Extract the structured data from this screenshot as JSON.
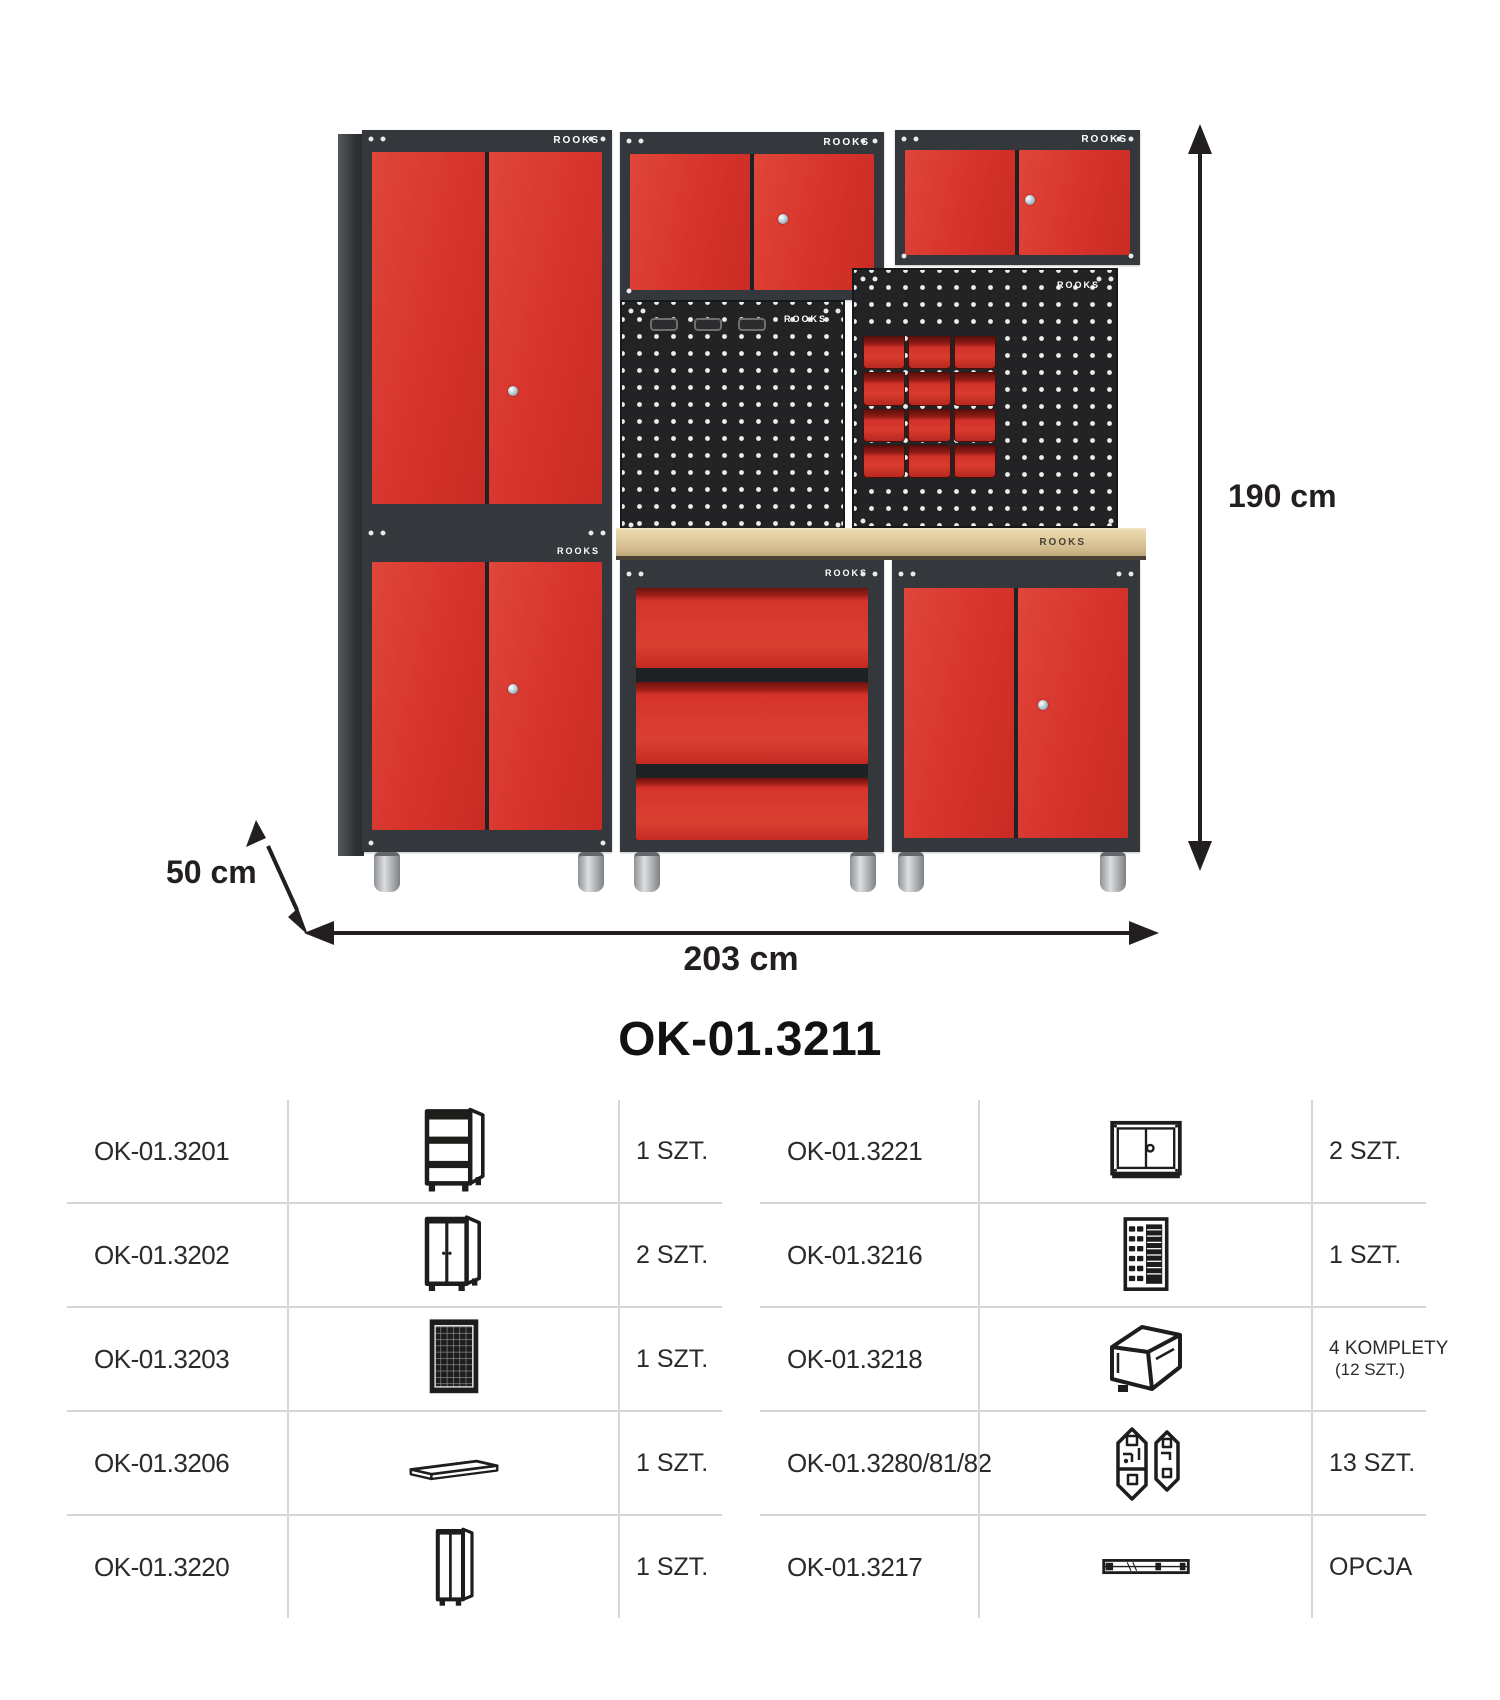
{
  "brand": "ROOKS",
  "figure": {
    "dimensions": {
      "height": "190 cm",
      "width": "203 cm",
      "depth": "50 cm"
    }
  },
  "title": "OK-01.3211",
  "table": {
    "left": [
      {
        "code": "OK-01.3201",
        "icon": "base-rack-icon",
        "qty": "1 SZT."
      },
      {
        "code": "OK-01.3202",
        "icon": "base-cabinet-icon",
        "qty": "2 SZT."
      },
      {
        "code": "OK-01.3203",
        "icon": "pegboard-icon",
        "qty": "1 SZT."
      },
      {
        "code": "OK-01.3206",
        "icon": "worktop-icon",
        "qty": "1 SZT."
      },
      {
        "code": "OK-01.3220",
        "icon": "tall-cabinet-icon",
        "qty": "1 SZT."
      }
    ],
    "right": [
      {
        "code": "OK-01.3221",
        "icon": "wall-cabinet-icon",
        "qty": "2 SZT."
      },
      {
        "code": "OK-01.3216",
        "icon": "bin-panel-icon",
        "qty": "1 SZT."
      },
      {
        "code": "OK-01.3218",
        "icon": "storage-bin-icon",
        "qty": "4 KOMPLETY",
        "qty_sub": "(12 SZT.)"
      },
      {
        "code": "OK-01.3280/81/82",
        "icon": "connectors-icon",
        "qty": "13 SZT."
      },
      {
        "code": "OK-01.3217",
        "icon": "drawer-slide-icon",
        "qty": "OPCJA"
      }
    ]
  },
  "colors": {
    "door_red": "#d6332b",
    "frame_dark": "#34373b",
    "pegboard": "#232325",
    "wood": "#d9c198",
    "divider_gray": "#d6d6d6",
    "text": "#231f20"
  }
}
